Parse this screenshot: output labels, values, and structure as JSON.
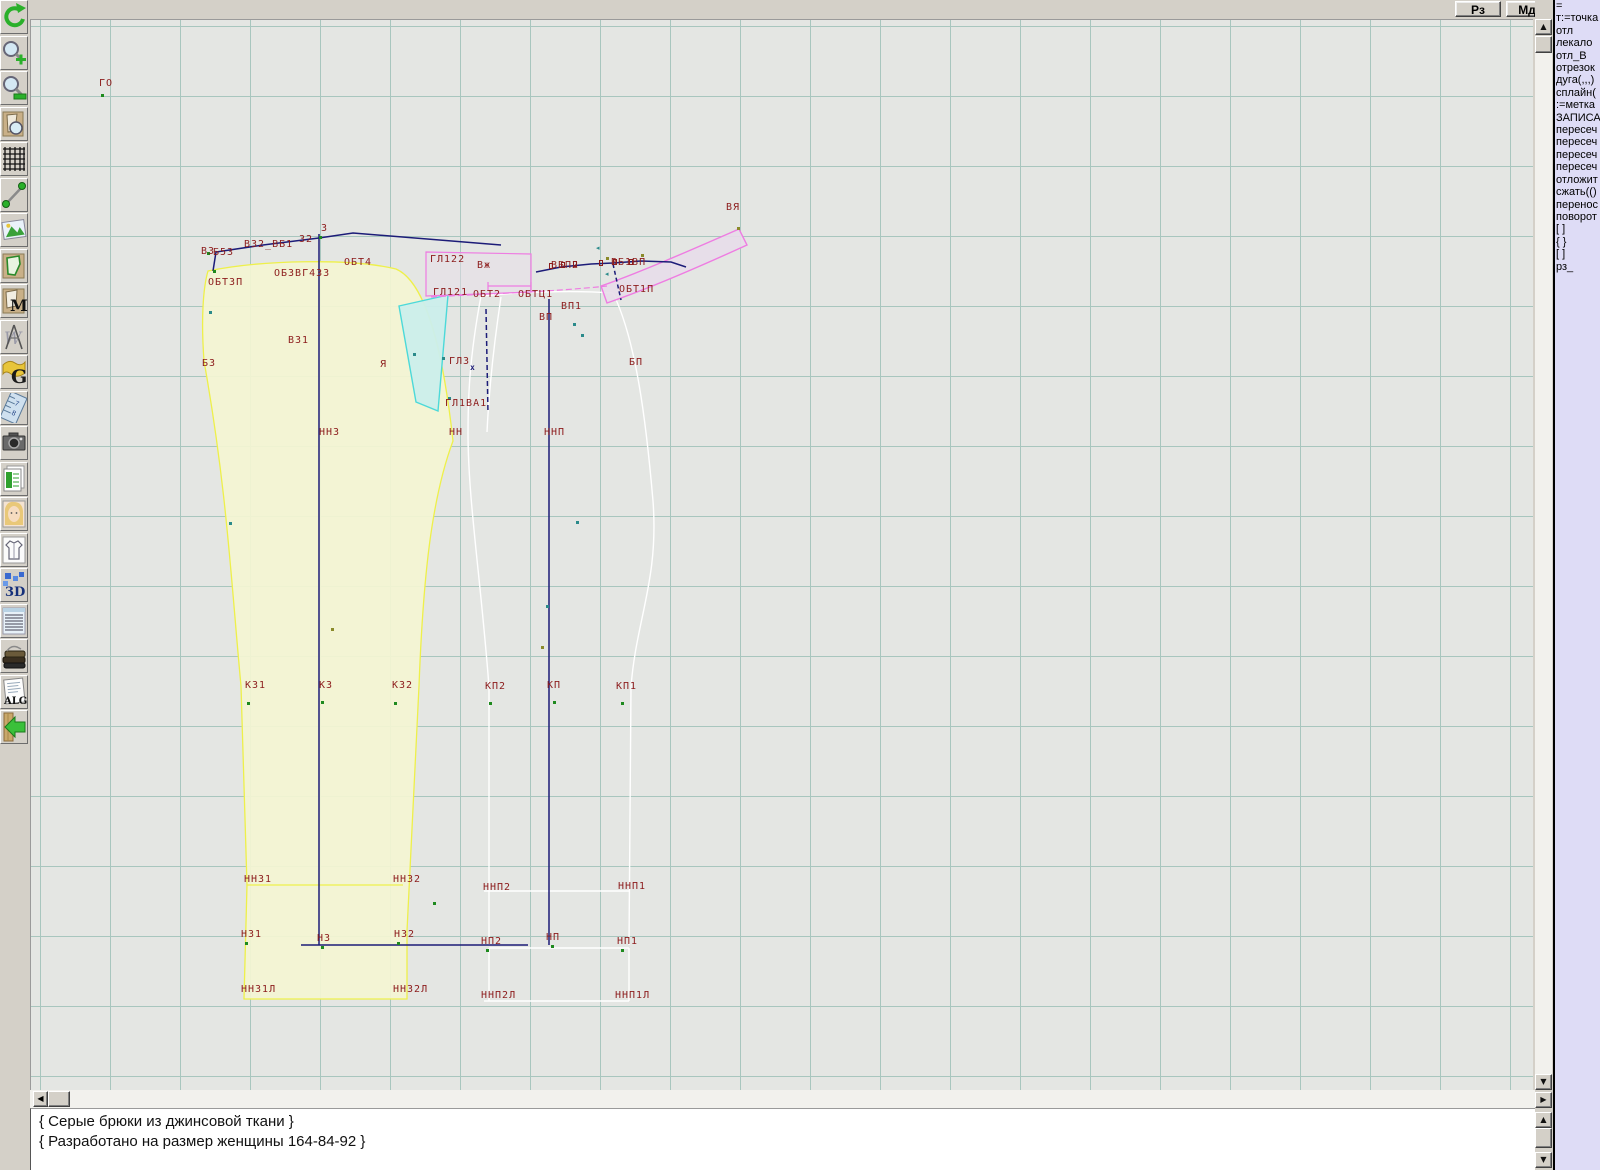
{
  "topbar": {
    "buttons": [
      {
        "label": "Рз"
      },
      {
        "label": "Мд"
      }
    ]
  },
  "toolbar": {
    "icons": [
      "undo-icon",
      "zoom-in-icon",
      "zoom-out-icon",
      "preview-pattern-icon",
      "grid-icon",
      "measure-line-icon",
      "image-icon",
      "pattern-piece-icon",
      "pattern-m-icon",
      "drafting-compass-icon",
      "g-letter-icon",
      "ruler-icon",
      "camera-icon",
      "table-icon",
      "model-photo-icon",
      "garment-sketch-icon",
      "3d-icon",
      "notes-icon",
      "books-icon",
      "alg-icon",
      "exit-icon"
    ]
  },
  "right_panel": {
    "lines": [
      "=",
      "т:=точка",
      "отл",
      "лекало",
      "отл_В",
      "отрезок",
      "дуга(,,,)",
      "сплайн(",
      ":=метка",
      "ЗАПИСА",
      "пересеч",
      "пересеч",
      "пересеч",
      "пересеч",
      "отложит",
      "сжать(()",
      "перенос",
      "поворот",
      "[ ]",
      "{ }",
      "[ ]",
      "рз_"
    ]
  },
  "status_panel": {
    "lines": [
      "{ Серые брюки из джинсовой ткани }",
      "{ Разработано на размер женщины 164-84-92 }"
    ]
  },
  "colors": {
    "canvas_bg": "#e4e6e3",
    "grid": "#a8c6be",
    "label": "#8c1c1c",
    "navy": "#1c1c78",
    "yellow_stroke": "#eef04a",
    "yellow_fill": "#f4f5d3",
    "white_line": "#ffffff",
    "cyan_stroke": "#4cd9d9",
    "cyan_fill": "#cbeeeb",
    "pink_stroke": "#ee7ce2",
    "pink_fill": "#e7dde9",
    "panel_bg": "#dedcf6",
    "status_bg": "#ffffff",
    "green_pt": "#1e8a1e",
    "teal_pt": "#2a8a8a",
    "olive_pt": "#8a8a2a"
  },
  "canvas": {
    "point_labels": [
      {
        "t": "ГО",
        "x": 68,
        "y": 58
      },
      {
        "t": "З",
        "x": 290,
        "y": 203
      },
      {
        "t": "ВЗ",
        "x": 170,
        "y": 226
      },
      {
        "t": "Б5З",
        "x": 182,
        "y": 227
      },
      {
        "t": "ВЗ2_ВБ1",
        "x": 213,
        "y": 219
      },
      {
        "t": "З2",
        "x": 268,
        "y": 214
      },
      {
        "t": "ОБТ4",
        "x": 313,
        "y": 237
      },
      {
        "t": "ОБТЗП",
        "x": 177,
        "y": 257
      },
      {
        "t": "ОБЗВГ4ЗЗ",
        "x": 243,
        "y": 248
      },
      {
        "t": "ГЛ122",
        "x": 399,
        "y": 234
      },
      {
        "t": "Вж",
        "x": 446,
        "y": 240
      },
      {
        "t": "ГЛ121",
        "x": 402,
        "y": 267
      },
      {
        "t": "ОБТ2",
        "x": 442,
        "y": 269
      },
      {
        "t": "ОБТЦ1",
        "x": 487,
        "y": 269
      },
      {
        "t": "ВБП2",
        "x": 520,
        "y": 240
      },
      {
        "t": "ВБ1ВП",
        "x": 580,
        "y": 237
      },
      {
        "t": "ОБТ1П",
        "x": 588,
        "y": 264
      },
      {
        "t": "ВЯ",
        "x": 695,
        "y": 182
      },
      {
        "t": "ВП1",
        "x": 530,
        "y": 281
      },
      {
        "t": "ВП",
        "x": 508,
        "y": 292
      },
      {
        "t": "ВЗ1",
        "x": 257,
        "y": 315
      },
      {
        "t": "БЗ",
        "x": 171,
        "y": 338
      },
      {
        "t": "Я",
        "x": 349,
        "y": 339
      },
      {
        "t": "ГЛЗ",
        "x": 418,
        "y": 336
      },
      {
        "t": "ГЛ1ВА1",
        "x": 414,
        "y": 378
      },
      {
        "t": "БП",
        "x": 598,
        "y": 337
      },
      {
        "t": "ННЗ",
        "x": 288,
        "y": 407
      },
      {
        "t": "НН",
        "x": 418,
        "y": 407
      },
      {
        "t": "ННП",
        "x": 513,
        "y": 407
      },
      {
        "t": "КЗ1",
        "x": 214,
        "y": 660
      },
      {
        "t": "КЗ",
        "x": 288,
        "y": 660
      },
      {
        "t": "КЗ2",
        "x": 361,
        "y": 660
      },
      {
        "t": "КП2",
        "x": 454,
        "y": 661
      },
      {
        "t": "КП",
        "x": 516,
        "y": 660
      },
      {
        "t": "КП1",
        "x": 585,
        "y": 661
      },
      {
        "t": "ННЗ1",
        "x": 213,
        "y": 854
      },
      {
        "t": "ННЗ2",
        "x": 362,
        "y": 854
      },
      {
        "t": "ННП2",
        "x": 452,
        "y": 862
      },
      {
        "t": "ННП1",
        "x": 587,
        "y": 861
      },
      {
        "t": "НЗ1",
        "x": 210,
        "y": 909
      },
      {
        "t": "НЗ",
        "x": 286,
        "y": 913
      },
      {
        "t": "НЗ2",
        "x": 363,
        "y": 909
      },
      {
        "t": "НП2",
        "x": 450,
        "y": 916
      },
      {
        "t": "НП",
        "x": 515,
        "y": 912
      },
      {
        "t": "НП1",
        "x": 586,
        "y": 916
      },
      {
        "t": "ННЗ1Л",
        "x": 210,
        "y": 964
      },
      {
        "t": "ННЗ2Л",
        "x": 362,
        "y": 964
      },
      {
        "t": "ННП2Л",
        "x": 450,
        "y": 970
      },
      {
        "t": "ННП1Л",
        "x": 584,
        "y": 970
      }
    ],
    "markers": [
      {
        "x": 70,
        "y": 74,
        "c": "green_pt"
      },
      {
        "x": 182,
        "y": 250,
        "c": "green_pt"
      },
      {
        "x": 288,
        "y": 216,
        "c": "green_pt"
      },
      {
        "x": 176,
        "y": 232,
        "c": "green_pt"
      },
      {
        "x": 216,
        "y": 682,
        "c": "green_pt"
      },
      {
        "x": 290,
        "y": 681,
        "c": "green_pt"
      },
      {
        "x": 363,
        "y": 682,
        "c": "green_pt"
      },
      {
        "x": 458,
        "y": 682,
        "c": "green_pt"
      },
      {
        "x": 522,
        "y": 681,
        "c": "green_pt"
      },
      {
        "x": 590,
        "y": 682,
        "c": "green_pt"
      },
      {
        "x": 402,
        "y": 882,
        "c": "green_pt"
      },
      {
        "x": 214,
        "y": 922,
        "c": "green_pt"
      },
      {
        "x": 290,
        "y": 926,
        "c": "green_pt"
      },
      {
        "x": 366,
        "y": 922,
        "c": "green_pt"
      },
      {
        "x": 455,
        "y": 929,
        "c": "green_pt"
      },
      {
        "x": 520,
        "y": 925,
        "c": "green_pt"
      },
      {
        "x": 590,
        "y": 929,
        "c": "green_pt"
      },
      {
        "x": 178,
        "y": 291,
        "c": "teal_pt"
      },
      {
        "x": 198,
        "y": 502,
        "c": "teal_pt"
      },
      {
        "x": 545,
        "y": 501,
        "c": "teal_pt"
      },
      {
        "x": 515,
        "y": 585,
        "c": "teal_pt"
      },
      {
        "x": 382,
        "y": 333,
        "c": "teal_pt"
      },
      {
        "x": 417,
        "y": 377,
        "c": "teal_pt"
      },
      {
        "x": 542,
        "y": 303,
        "c": "teal_pt"
      },
      {
        "x": 550,
        "y": 314,
        "c": "teal_pt"
      },
      {
        "x": 411,
        "y": 337,
        "c": "teal_pt"
      },
      {
        "x": 300,
        "y": 608,
        "c": "olive_pt"
      },
      {
        "x": 510,
        "y": 626,
        "c": "olive_pt"
      },
      {
        "x": 575,
        "y": 237,
        "c": "olive_pt"
      },
      {
        "x": 610,
        "y": 234,
        "c": "olive_pt"
      },
      {
        "x": 706,
        "y": 207,
        "c": "olive_pt"
      }
    ],
    "dart_squares": [
      {
        "x": 518,
        "y": 243
      },
      {
        "x": 530,
        "y": 242
      },
      {
        "x": 542,
        "y": 241
      },
      {
        "x": 568,
        "y": 240
      },
      {
        "x": 582,
        "y": 239
      },
      {
        "x": 598,
        "y": 239
      }
    ],
    "x_marks": [
      {
        "t": "х",
        "x": 439,
        "y": 343
      }
    ],
    "arrow_marks": [
      {
        "t": "◂",
        "x": 565,
        "y": 224
      },
      {
        "t": "◂",
        "x": 574,
        "y": 250
      }
    ]
  }
}
